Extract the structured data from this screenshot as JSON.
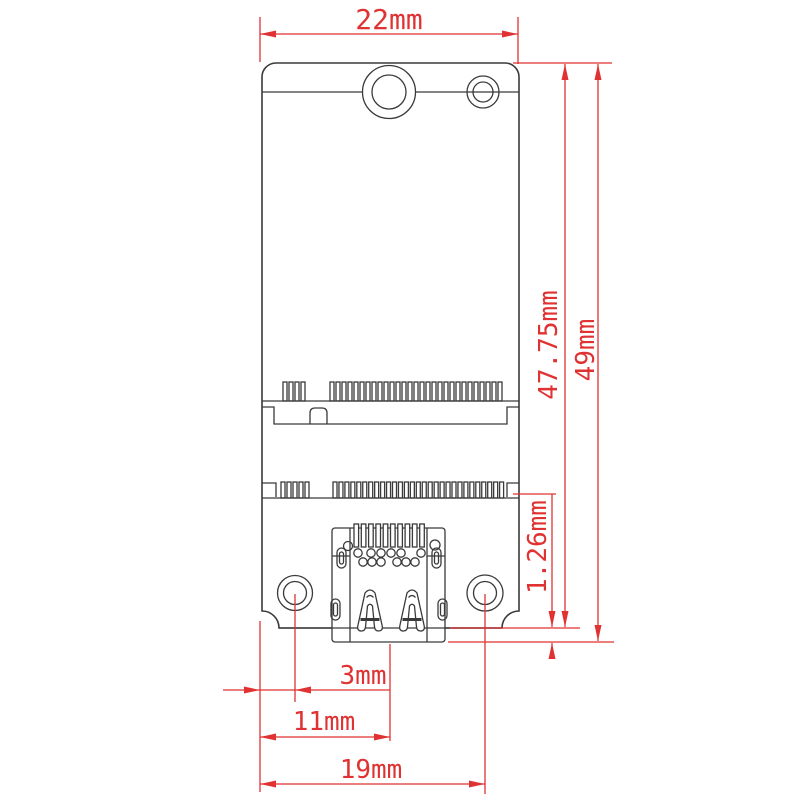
{
  "drawing": {
    "labels": {
      "top_width": "22mm",
      "pcb_height": "47.75mm",
      "overall_height": "49mm",
      "connector_overhang": "1.26mm",
      "edge_to_hole": "3mm",
      "edge_to_center": "11mm",
      "edge_to_right_hole": "19mm"
    },
    "colors": {
      "dimension_red": "#e03232",
      "outline_dark": "#3a3a3a",
      "background": "#ffffff"
    }
  }
}
